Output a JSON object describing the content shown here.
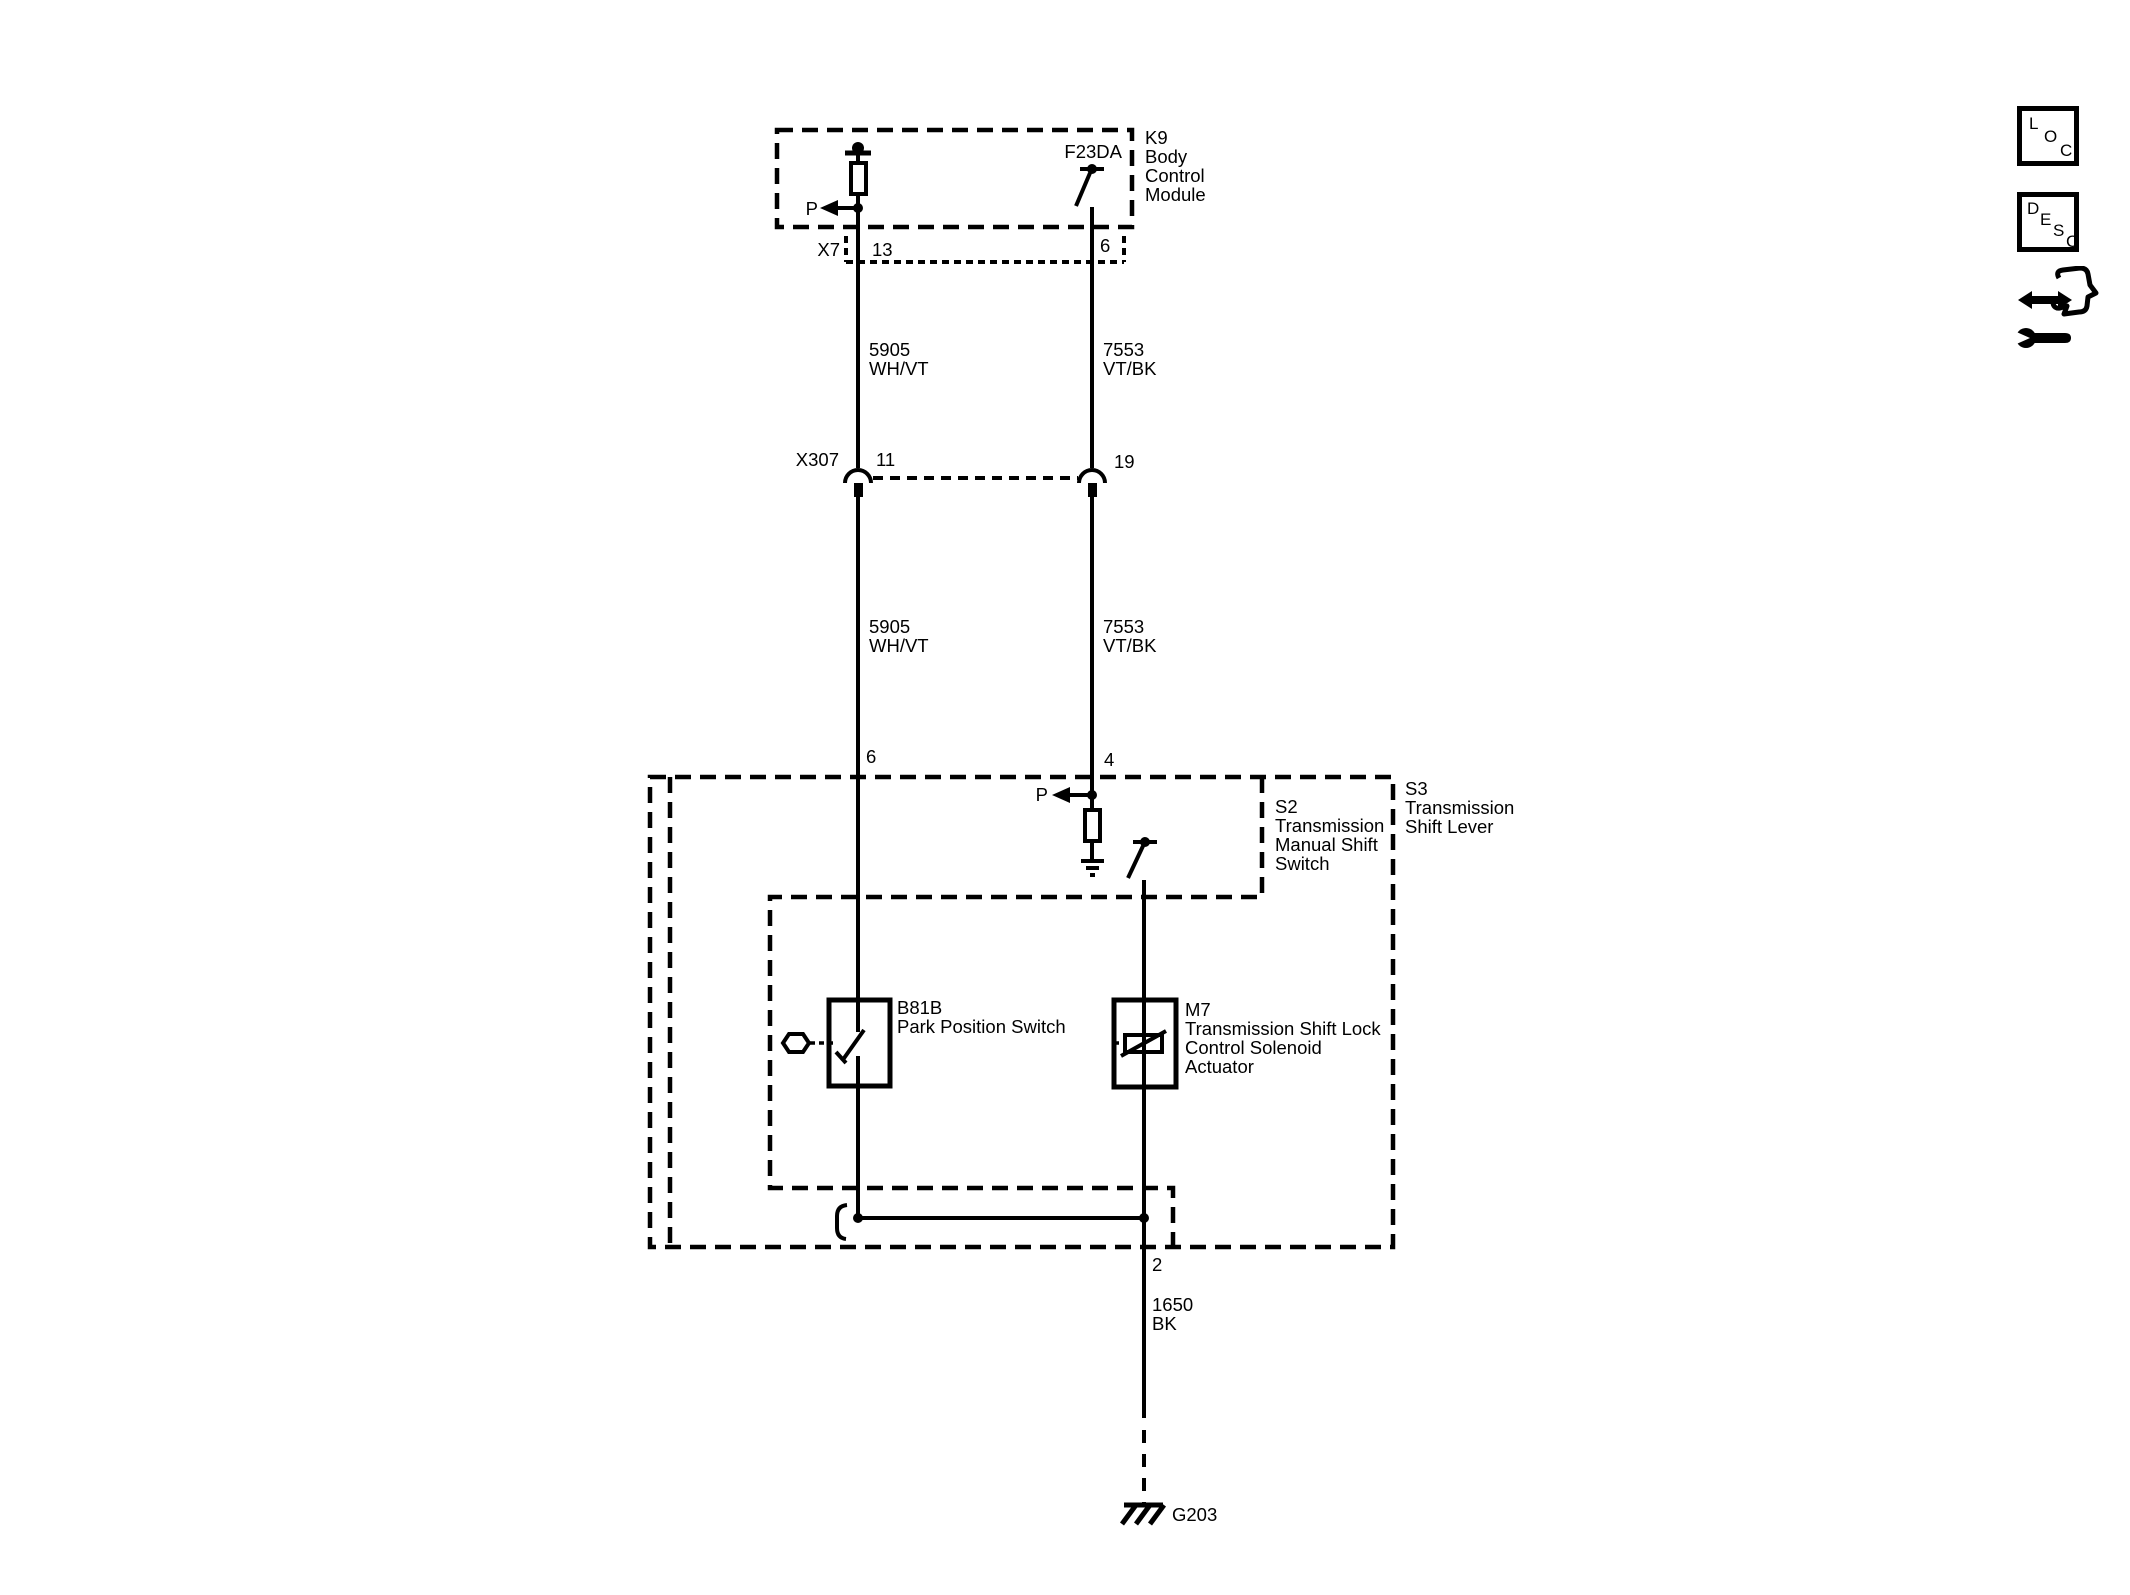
{
  "diagram": {
    "k9_module": {
      "ref": "K9",
      "name": [
        "Body",
        "Control",
        "Module"
      ],
      "driver_label": "F23DA",
      "park_signal": "P"
    },
    "x7_connector": {
      "ref": "X7",
      "pin_left": "13",
      "pin_right": "6"
    },
    "wire_5905": {
      "circuit": "5905",
      "color": "WH/VT"
    },
    "wire_7553": {
      "circuit": "7553",
      "color": "VT/BK"
    },
    "x307_connector": {
      "ref": "X307",
      "pin_left": "11",
      "pin_right": "19"
    },
    "s3_assembly": {
      "ref": "S3",
      "name": [
        "Transmission",
        "Shift Lever"
      ],
      "pin_left": "6",
      "pin_right": "4"
    },
    "s2_switch": {
      "ref": "S2",
      "name": [
        "Transmission",
        "Manual Shift",
        "Switch"
      ],
      "park_signal": "P"
    },
    "b81b_switch": {
      "ref": "B81B",
      "name": "Park Position Switch"
    },
    "m7_actuator": {
      "ref": "M7",
      "name": [
        "Transmission Shift Lock",
        "Control Solenoid",
        "Actuator"
      ]
    },
    "wire_1650": {
      "pin": "2",
      "circuit": "1650",
      "color": "BK"
    },
    "ground": {
      "ref": "G203"
    }
  },
  "nav_icons": {
    "loc": [
      "L",
      "O",
      "C"
    ],
    "desc": [
      "D",
      "E",
      "S",
      "C"
    ]
  },
  "colors": {
    "line": "#000000",
    "background": "#ffffff"
  }
}
